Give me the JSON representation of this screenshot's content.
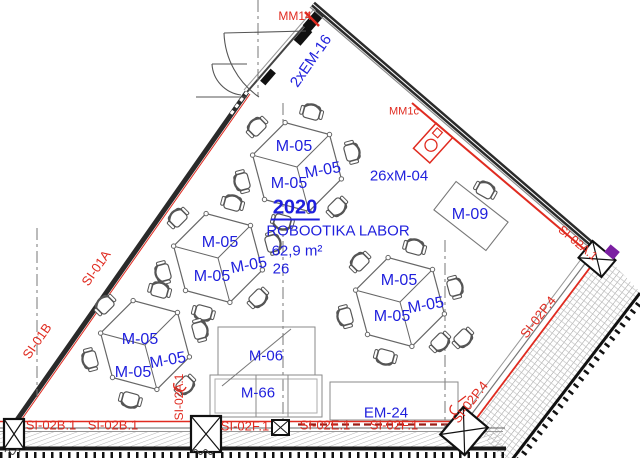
{
  "drawing": {
    "type": "floor-plan",
    "room": {
      "number": "2020",
      "name": "ROBOOTIKA LABOR",
      "area": "62,9 m²",
      "capacity": "26"
    }
  },
  "colors": {
    "label_blue": "#1f1fdd",
    "label_red": "#e02b20",
    "wall_dark": "#2a2a2a",
    "radiator_dark_red": "#9b1c15",
    "accent_purple": "#7b1fa2"
  },
  "furniture": {
    "clusters": [
      [
        297,
        167
      ],
      [
        218,
        258
      ],
      [
        145,
        345
      ],
      [
        400,
        302
      ]
    ],
    "desk": {
      "x": 471,
      "y": 216,
      "rot": 38
    },
    "lone_chairs": [
      {
        "x": 486,
        "y": 189,
        "rot": 209
      },
      {
        "x": 464,
        "y": 339,
        "rot": -45
      }
    ]
  },
  "annotations": [
    {
      "name": "label-door-2xem16",
      "text": "2xEM-16",
      "x": 311,
      "y": 61,
      "rot": -55,
      "cls": "blue",
      "size": 15
    },
    {
      "name": "label-chairs-26xm04",
      "text": "26xM-04",
      "x": 399,
      "y": 176,
      "rot": 0,
      "cls": "blue",
      "size": 15
    },
    {
      "name": "room-number",
      "text": "2020",
      "x": 295,
      "y": 209,
      "rot": 0,
      "cls": "blue bold u",
      "size": 20
    },
    {
      "name": "room-name",
      "text": "ROBOOTIKA LABOR",
      "x": 338,
      "y": 231,
      "rot": 0,
      "cls": "blue",
      "size": 15
    },
    {
      "name": "room-area",
      "text": "62,9 m²",
      "x": 297,
      "y": 251,
      "rot": 0,
      "cls": "blue",
      "size": 15
    },
    {
      "name": "room-capacity",
      "text": "26",
      "x": 281,
      "y": 269,
      "rot": 0,
      "cls": "blue",
      "size": 15
    },
    {
      "name": "label-table-m05",
      "text": "M-05",
      "x": 294,
      "y": 147,
      "rot": 0,
      "cls": "blue",
      "size": 16
    },
    {
      "name": "label-table-m05",
      "text": "M-05",
      "x": 323,
      "y": 171,
      "rot": -10,
      "cls": "blue",
      "size": 16
    },
    {
      "name": "label-table-m05",
      "text": "M-05",
      "x": 289,
      "y": 184,
      "rot": 0,
      "cls": "blue",
      "size": 16
    },
    {
      "name": "label-table-m05",
      "text": "M-05",
      "x": 220,
      "y": 243,
      "rot": 0,
      "cls": "blue",
      "size": 16
    },
    {
      "name": "label-table-m05",
      "text": "M-05",
      "x": 249,
      "y": 266,
      "rot": -10,
      "cls": "blue",
      "size": 16
    },
    {
      "name": "label-table-m05",
      "text": "M-05",
      "x": 212,
      "y": 277,
      "rot": 0,
      "cls": "blue",
      "size": 16
    },
    {
      "name": "label-table-m05",
      "text": "M-05",
      "x": 140,
      "y": 340,
      "rot": 0,
      "cls": "blue",
      "size": 16
    },
    {
      "name": "label-table-m05",
      "text": "M-05",
      "x": 168,
      "y": 361,
      "rot": -10,
      "cls": "blue",
      "size": 16
    },
    {
      "name": "label-table-m05",
      "text": "M-05",
      "x": 133,
      "y": 373,
      "rot": 0,
      "cls": "blue",
      "size": 16
    },
    {
      "name": "label-table-m05",
      "text": "M-05",
      "x": 399,
      "y": 281,
      "rot": 0,
      "cls": "blue",
      "size": 16
    },
    {
      "name": "label-table-m05",
      "text": "M-05",
      "x": 426,
      "y": 306,
      "rot": -10,
      "cls": "blue",
      "size": 16
    },
    {
      "name": "label-table-m05",
      "text": "M-05",
      "x": 392,
      "y": 317,
      "rot": 0,
      "cls": "blue",
      "size": 16
    },
    {
      "name": "label-desk-m09",
      "text": "M-09",
      "x": 470,
      "y": 215,
      "rot": 0,
      "cls": "blue",
      "size": 16
    },
    {
      "name": "label-m06",
      "text": "M-06",
      "x": 266,
      "y": 356,
      "rot": 0,
      "cls": "blue",
      "size": 15
    },
    {
      "name": "label-m66",
      "text": "M-66",
      "x": 258,
      "y": 393,
      "rot": 0,
      "cls": "blue",
      "size": 15
    },
    {
      "name": "label-em24",
      "text": "EM-24",
      "x": 386,
      "y": 413,
      "rot": 0,
      "cls": "blue",
      "size": 15
    },
    {
      "name": "label-mm14",
      "text": "MM14",
      "x": 295,
      "y": 16,
      "rot": 0,
      "cls": "red",
      "size": 12
    },
    {
      "name": "label-mm1c",
      "text": "MM1c",
      "x": 404,
      "y": 112,
      "rot": 0,
      "cls": "red",
      "size": 11
    },
    {
      "name": "label-si01a",
      "text": "SI-01A",
      "x": 96,
      "y": 268,
      "rot": -55,
      "cls": "red",
      "size": 13
    },
    {
      "name": "label-si01b",
      "text": "SI-01B",
      "x": 37,
      "y": 341,
      "rot": -55,
      "cls": "red",
      "size": 13
    },
    {
      "name": "label-si02b1",
      "text": "SI-02B.1",
      "x": 51,
      "y": 425,
      "rot": 0,
      "cls": "red",
      "size": 13
    },
    {
      "name": "label-si02b1",
      "text": "SI-02B.1",
      "x": 113,
      "y": 425,
      "rot": 0,
      "cls": "red",
      "size": 13
    },
    {
      "name": "label-si02a1",
      "text": "SI-02A.1",
      "x": 179,
      "y": 397,
      "rot": -90,
      "cls": "red",
      "size": 12
    },
    {
      "name": "label-si02f1",
      "text": "SI-02F.1",
      "x": 245,
      "y": 426,
      "rot": 0,
      "cls": "red",
      "size": 13
    },
    {
      "name": "label-si02e1",
      "text": "SI-02E.1",
      "x": 325,
      "y": 425,
      "rot": 0,
      "cls": "red",
      "size": 13
    },
    {
      "name": "label-si02f1",
      "text": "SI-02F.1",
      "x": 394,
      "y": 425,
      "rot": 0,
      "cls": "red",
      "size": 13
    },
    {
      "name": "label-si02p4",
      "text": "SI-02P.4",
      "x": 538,
      "y": 317,
      "rot": -52,
      "cls": "red",
      "size": 13
    },
    {
      "name": "label-si02p4",
      "text": "SI-02P.4",
      "x": 470,
      "y": 402,
      "rot": -52,
      "cls": "red",
      "size": 13
    },
    {
      "name": "label-si02a1",
      "text": "SI-02A.1",
      "x": 578,
      "y": 243,
      "rot": 40,
      "cls": "red",
      "size": 12
    }
  ]
}
